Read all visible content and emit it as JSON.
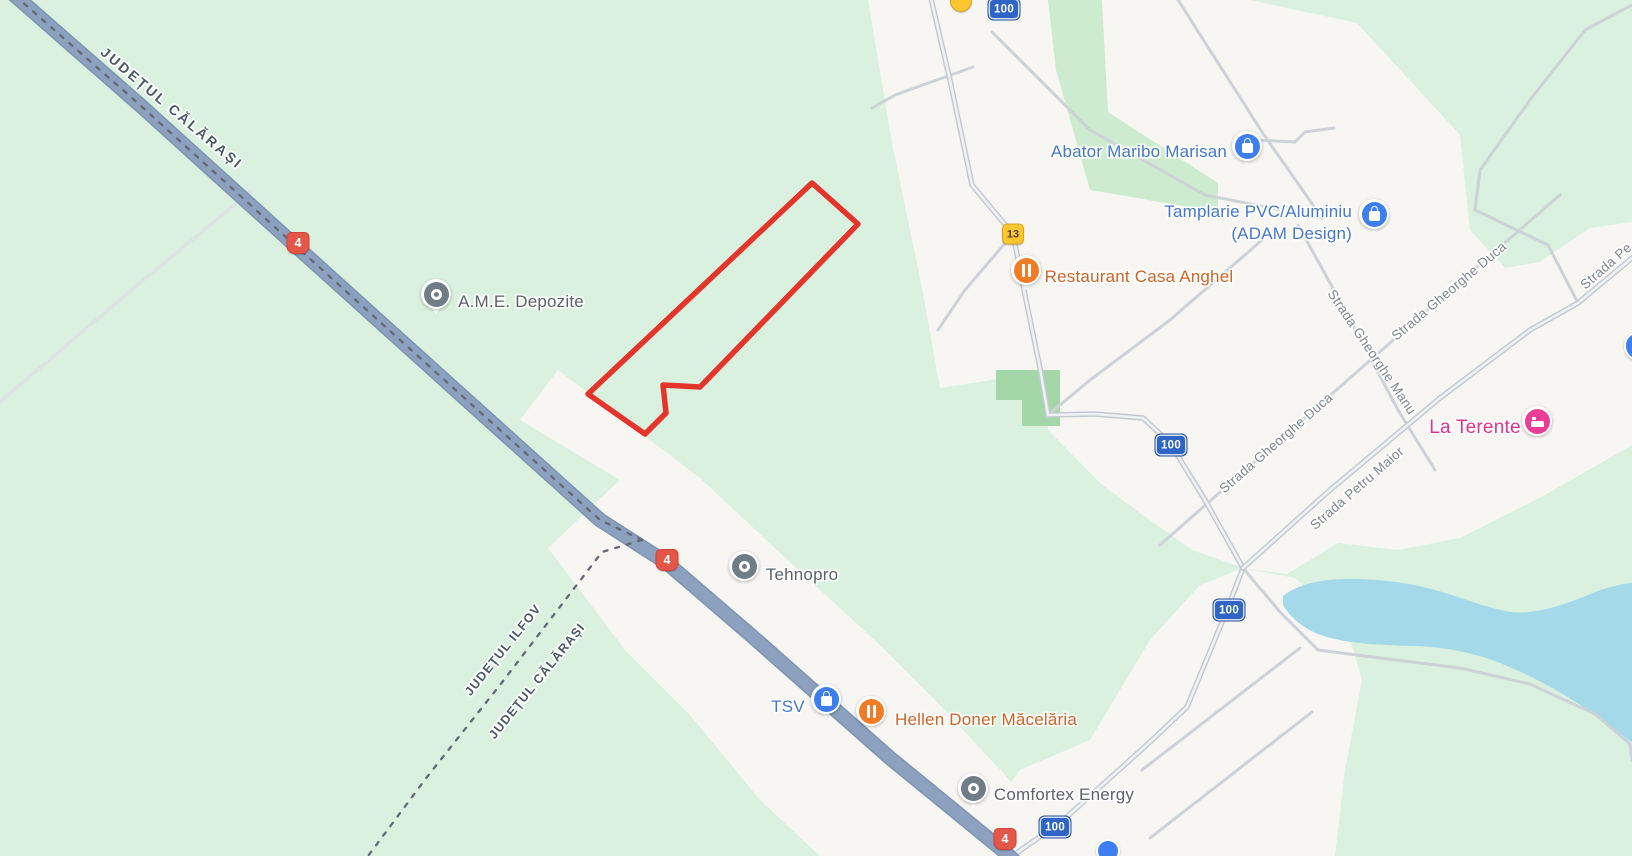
{
  "county_labels": {
    "calarasi_top": "JUDEȚUL CĂLĂRAȘI",
    "ilfov": "JUDEȚUL ILFOV",
    "calarasi_bottom": "JUDEȚUL CĂLĂRAȘI"
  },
  "street_labels": {
    "gheorghe_duca_upper": "Strada Gheorghe Duca",
    "gheorghe_manu": "Strada Gheorghe Manu",
    "petru_maior": "Strada Petru Maior",
    "gheorghe_duca_lower": "Strada Gheorghe Duca",
    "strada_edge_clipped": "Strada Pe"
  },
  "pois": {
    "ame_depozite": "A.M.E. Depozite",
    "abator": "Abator Maribo Marisan",
    "tamplarie_line1": "Tamplarie PVC/Aluminiu",
    "tamplarie_line2": "(ADAM Design)",
    "restaurant": "Restaurant Casa Anghel",
    "la_terente": "La Terente",
    "tehnopro": "Tehnopro",
    "tsv": "TSV",
    "hellen": "Hellen Doner Măcelăria",
    "comfortex": "Comfortex Energy"
  },
  "shields": {
    "route4": "4",
    "route100": "100",
    "route13": "13"
  },
  "colors": {
    "bg_green": "#d9f1de",
    "urban": "#f8f6f3",
    "park_green": "#a3d7a8",
    "field_green": "#cdeccf",
    "water": "#a3d9e9",
    "highway": "#8ba1bf",
    "road_minor": "#cdd2d8",
    "red_outline": "#e4342b",
    "shield_red": "#e45648",
    "shield_blue": "#2f66c6",
    "shield_yellow": "#fbc62f",
    "poi_blue": "#3d7ef0",
    "poi_orange": "#f07c25",
    "poi_pink": "#ec3d96",
    "text_blue": "#4478cf",
    "text_orange": "#cd6527",
    "text_pink": "#dc3590",
    "text_gray": "#5d6368",
    "text_street": "#7f868d",
    "text_county": "#4a5a63"
  }
}
